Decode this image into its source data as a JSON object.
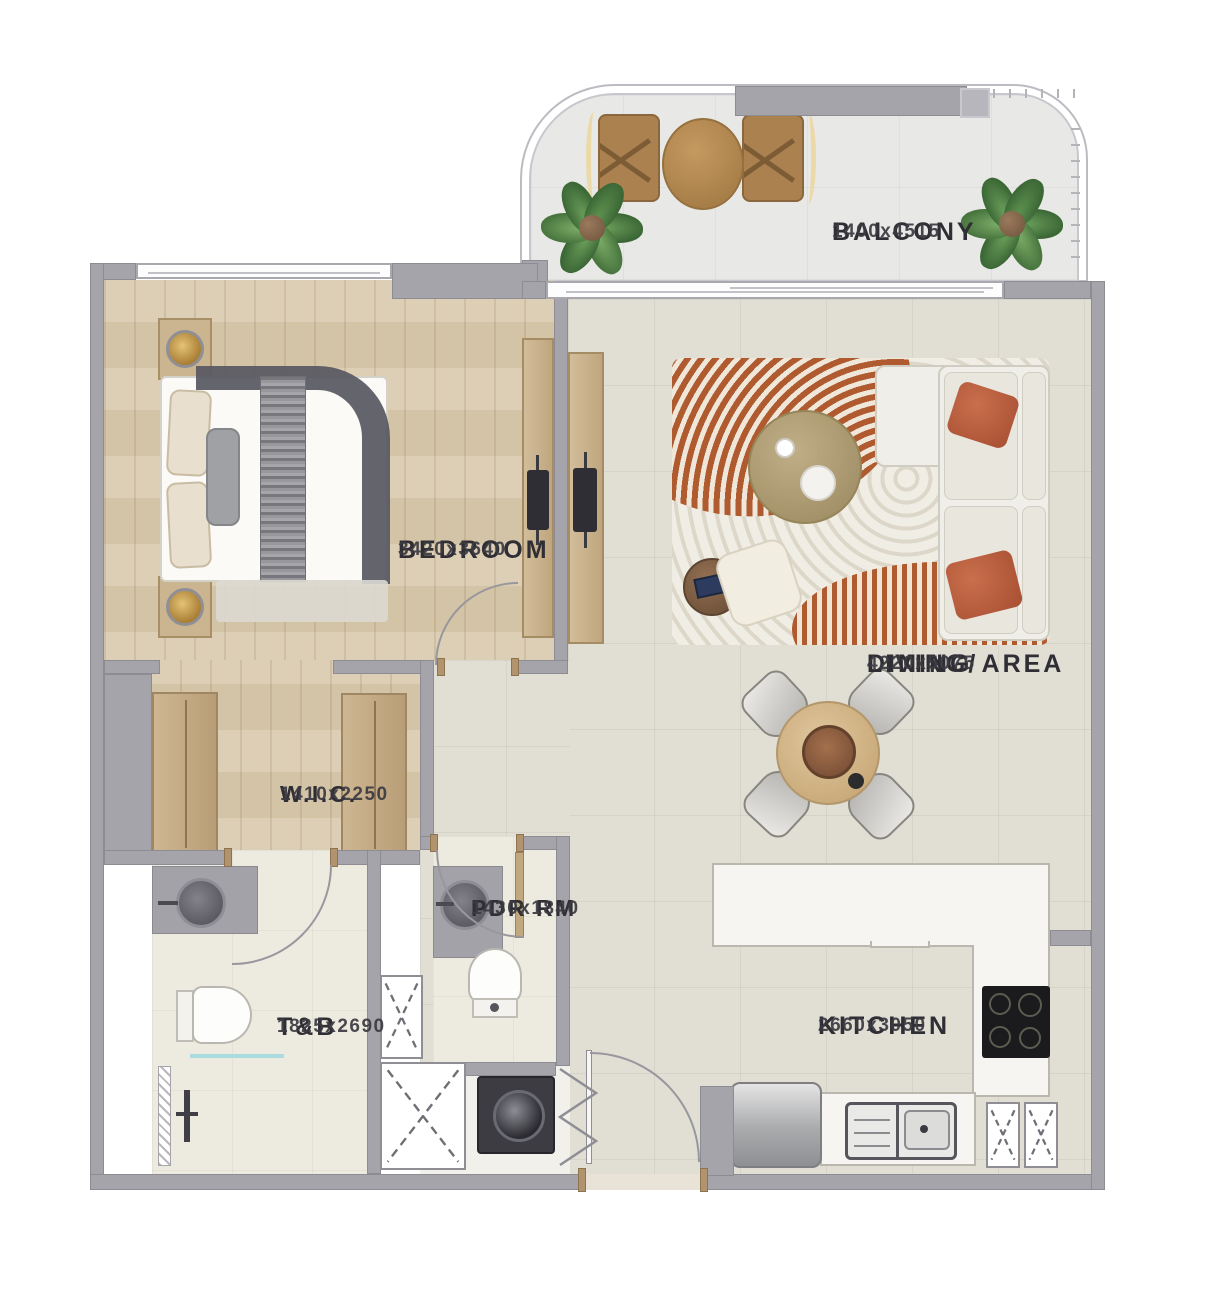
{
  "plan": {
    "title": "1-bedroom apartment floor plan",
    "rooms": {
      "balcony": {
        "label": "BALCONY",
        "dimensions": "1400x4515"
      },
      "bedroom": {
        "label": "BEDROOM",
        "dimensions": "3420x3640"
      },
      "living_dining": {
        "label_line1": "LIVING/",
        "label_line2": "DINING AREA",
        "dimensions": "4220x5075"
      },
      "wic": {
        "label": "W.I.C.",
        "dimensions": "1410x2250"
      },
      "pdr": {
        "label": "PDR RM",
        "dimensions": "1430x1840"
      },
      "tb": {
        "label": "T&B",
        "dimensions": "1825x2690"
      },
      "kitchen": {
        "label": "KITCHEN",
        "dimensions": "2660x3050"
      }
    },
    "colors": {
      "wall": "#a5a4ab",
      "wood_floor": "#d9caae",
      "tile_floor": "#e1ded4",
      "bath_floor": "#edeadf",
      "balcony_floor": "#e8e8e6",
      "accent_terracotta": "#b05a2f",
      "label_text": "#2f2e35"
    }
  }
}
